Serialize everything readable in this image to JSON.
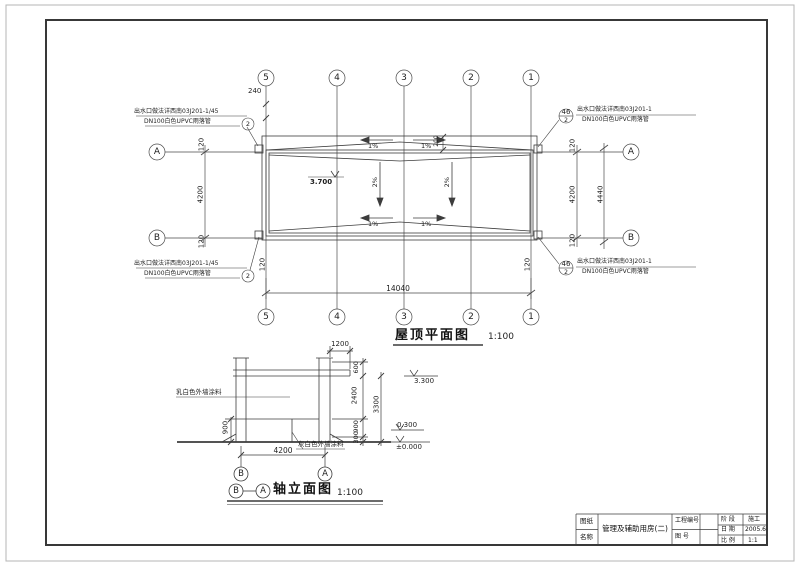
{
  "plan": {
    "title": "屋顶平面图",
    "scale": "1:100",
    "grid_cols": [
      "5",
      "4",
      "3",
      "2",
      "1"
    ],
    "grid_rows": [
      "A",
      "B"
    ],
    "dims": {
      "overall": "14040",
      "bay_left": "4200",
      "bay_right": "4200",
      "overall_right": "4440",
      "edge": "120",
      "parapet_top": "240",
      "gutter": "200"
    },
    "slope_main": "2%",
    "slope_gutter": "1%",
    "roof_level": "3.700",
    "note_left": {
      "line1": "出水口做法详西南03J201-1/45",
      "line2": "DN100白色UPVC雨落管",
      "bubble": "2"
    },
    "note_right": {
      "detail_no": "46",
      "sheet_no": "2",
      "line1": "出水口做法详西南03J201-1",
      "line2": "DN100白色UPVC雨落管"
    }
  },
  "elevation": {
    "title": "轴立面图",
    "scale": "1:100",
    "grid_start": "B",
    "grid_end": "A",
    "dims": {
      "canopy": "1200",
      "bottom": "4200",
      "left": "900",
      "chain": [
        "600",
        "2400",
        "900",
        "300"
      ],
      "overall": "3300"
    },
    "levels": {
      "roof": "3.300",
      "plinth": "0.300",
      "ground": "±0.000"
    },
    "note_wall": "乳白色外墙涂料",
    "note_base": "灰白色外墙涂料"
  },
  "titleblock": {
    "label_sheet": "图纸",
    "label_name": "名称",
    "project_name": "管理及辅助用房(二)",
    "label_project_no": "工程编号",
    "label_drawing_no": "图 号",
    "stage_label": "阶 段",
    "stage_value": "施工",
    "date_label": "日 期",
    "date_value": "2005.6",
    "scale_label": "比 例",
    "scale_value": "1:1"
  }
}
